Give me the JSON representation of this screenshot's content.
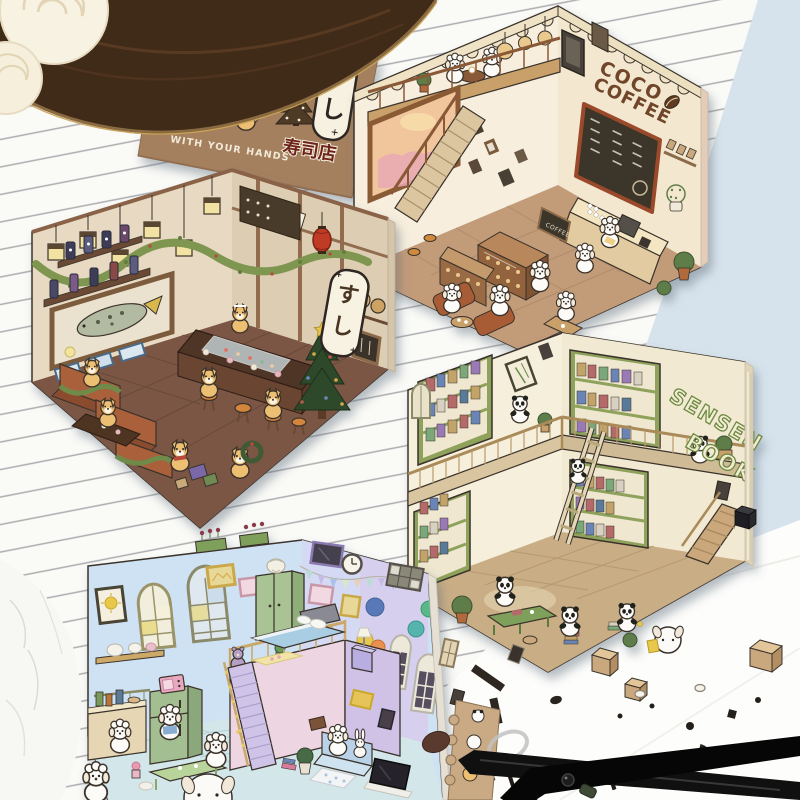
{
  "scene": {
    "description": "Product photo: four cute isometric paper diorama room cards (dog coffee shop, shiba sushi bar, panda bookstore, pastel puppy bedroom) arranged on ruled paper with a wooden tray, cream roses, sticker sheets and black scissors",
    "colors": {
      "backdrop": "#d7e3ec",
      "paper": "#fafaf7",
      "rule_line": "#60606a",
      "tray_wood": "#402a18",
      "scissors": "#101010"
    }
  },
  "coffee_card": {
    "sign_line1": "COCO",
    "sign_line2": "COFFEE",
    "menu_sign": "COFFEE",
    "wall": "#f7eedd",
    "floor": "#c29b79",
    "accent": "#6f4429"
  },
  "sushi_card": {
    "wall_su": "す",
    "wall_shi": "し",
    "wall": "#e7d9c2",
    "floor": "#7b5645",
    "accent": "#bf3a28"
  },
  "book_card": {
    "sign_line1": "SENSEN",
    "sign_line2": "BOOK",
    "wall": "#f6efdb",
    "floor": "#c9ad85",
    "accent": "#8ea25c"
  },
  "bedroom_card": {
    "wall": "#cfe2f4",
    "floor": "#d3e7ea",
    "accent": "#eed5e2"
  },
  "kraft_card": {
    "phrase": "WITH YOUR HANDS",
    "kanji": "寿司店",
    "su": "す",
    "shi": "し",
    "color": "#a5805f"
  }
}
